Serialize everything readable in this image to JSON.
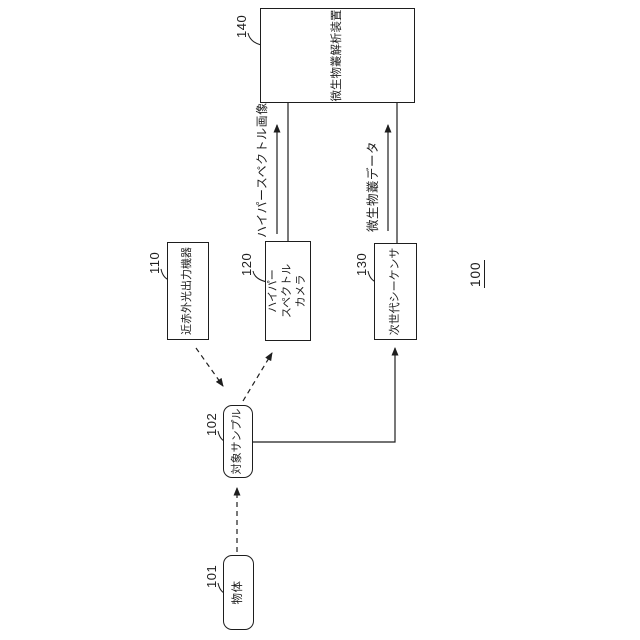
{
  "figure": {
    "system_ref": "100",
    "boxes": {
      "object": {
        "ref": "101",
        "label": "物体"
      },
      "sample": {
        "ref": "102",
        "label": "対象サンプル"
      },
      "nir_light_source": {
        "ref": "110",
        "label": "近赤外光出力機器"
      },
      "hyperspectral_camera": {
        "ref": "120",
        "line1": "ハイパー",
        "line2": "スペクトル",
        "line3": "カメラ"
      },
      "ngs_sequencer": {
        "ref": "130",
        "label": "次世代シーケンサ"
      },
      "microbiome_analyzer": {
        "ref": "140",
        "label": "微生物叢解析装置"
      }
    },
    "flows": {
      "hyperspectral_image_label": "ハイパースペクトル画像",
      "microbiome_data_label": "微生物叢データ"
    },
    "colors": {
      "line": "#1e1e1e",
      "background": "#ffffff"
    }
  }
}
